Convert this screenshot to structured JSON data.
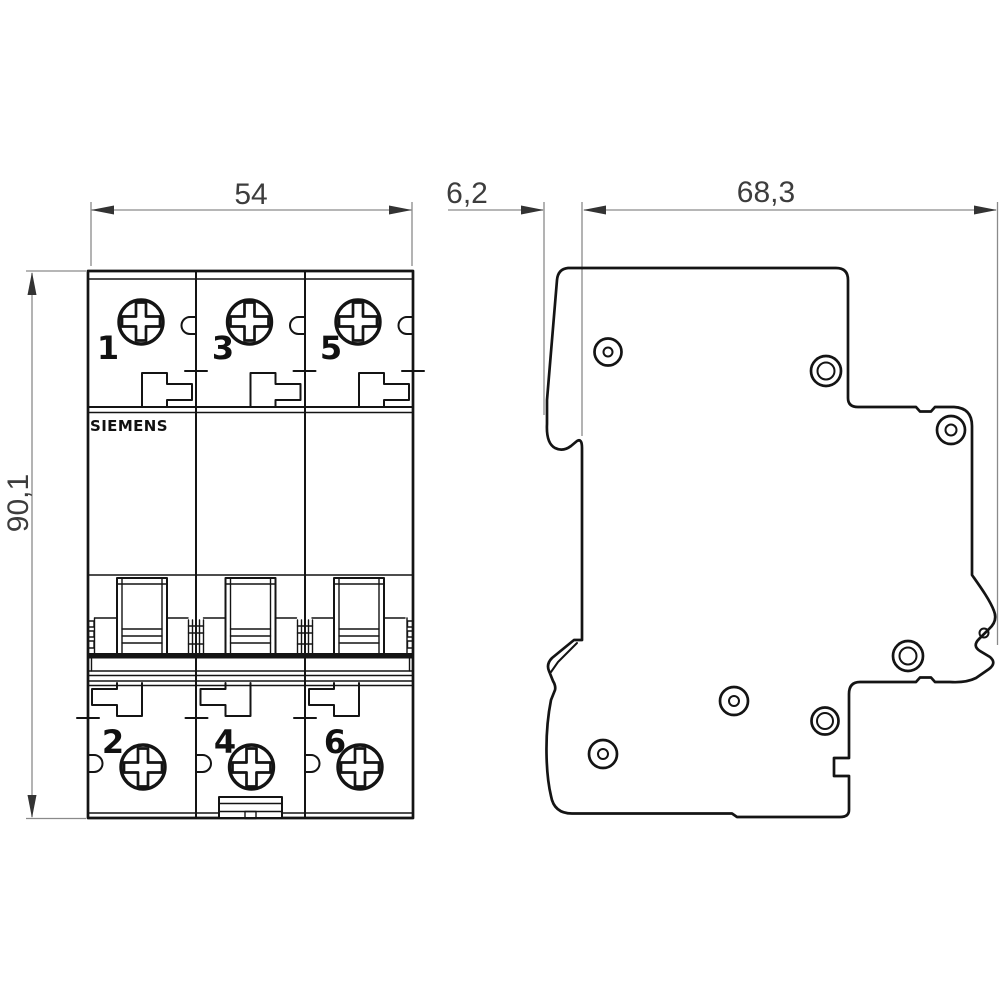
{
  "brand": "SIEMENS",
  "dimensions": {
    "width": "54",
    "height": "90,1",
    "depth_front": "6,2",
    "depth_body": "68,3"
  },
  "front_view": {
    "top_terminals": [
      "1",
      "3",
      "5"
    ],
    "bottom_terminals": [
      "2",
      "4",
      "6"
    ]
  },
  "colors": {
    "outline": "#141414",
    "dimension_line": "#8a8a8a",
    "dimension_text": "#3d3d3d",
    "background": "#ffffff"
  }
}
